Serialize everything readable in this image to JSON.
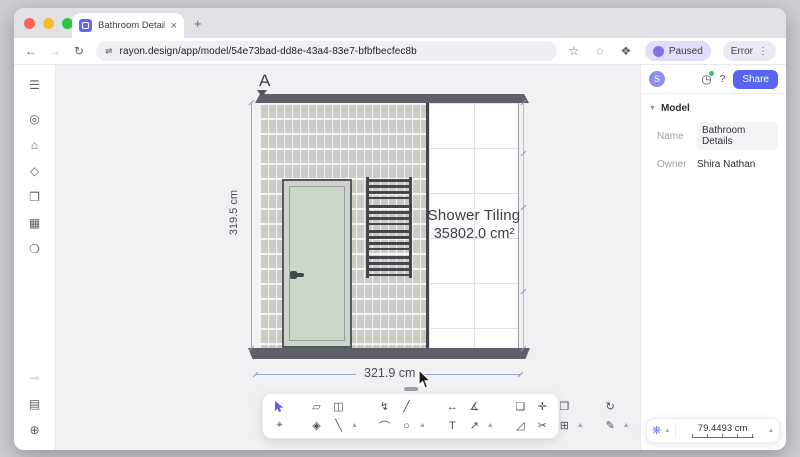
{
  "browser": {
    "tab_title": "Bathroom Details  | Rayon",
    "tab_close": "×",
    "new_tab": "+",
    "back": "←",
    "forward": "→",
    "reload": "↻",
    "site_settings_icon": "⇌",
    "url": "rayon.design/app/model/54e73bad-dd8e-43a4-83e7-bfbfbecfec8b",
    "bookmark_icon": "☆",
    "lens_icon": "◌",
    "extensions_icon": "❖",
    "paused_label": "Paused",
    "error_label": "Error",
    "kebab": "⋮"
  },
  "sidebar": {
    "top": [
      {
        "n": "menu-icon",
        "g": "☰",
        "menu": true
      },
      {
        "n": "scene-icon",
        "g": "◎"
      },
      {
        "n": "model-cube-icon",
        "g": "⌂"
      },
      {
        "n": "materials-icon",
        "g": "◇"
      },
      {
        "n": "pages-icon",
        "g": "❐"
      },
      {
        "n": "tables-icon",
        "g": "▦"
      },
      {
        "n": "comments-icon",
        "g": "❍"
      }
    ],
    "bottom": [
      {
        "n": "plugins-icon",
        "g": "⊸",
        "muted": true
      },
      {
        "n": "library-icon",
        "g": "▤"
      },
      {
        "n": "help-icon",
        "g": "⊕"
      }
    ]
  },
  "panel": {
    "avatar": "S",
    "history_icon": "◷",
    "help_label": "?",
    "share_label": "Share",
    "section_chevron": "▼",
    "section_title": "Model",
    "fields": [
      {
        "label": "Name",
        "value": "Bathroom Details",
        "input": true
      },
      {
        "label": "Owner",
        "value": "Shira Nathan",
        "input": false
      }
    ]
  },
  "canvas": {
    "section_marker": "A",
    "height_dim": "319.5 cm",
    "width_dim": "321.9 cm",
    "area_title": "Shower Tiling",
    "area_value": "35802.0 cm²"
  },
  "toolbar": {
    "groups": [
      {
        "cols": [
          {
            "top": {
              "n": "select-tool",
              "g": "svg:cursor",
              "active": true
            },
            "bot": {
              "n": "node-select-tool",
              "g": "⌖"
            }
          }
        ],
        "chevron": false
      },
      {
        "cols": [
          {
            "top": {
              "n": "slab-tool",
              "g": "▱"
            },
            "bot": {
              "n": "hatch-tool",
              "g": "◈"
            }
          },
          {
            "top": {
              "n": "door-tool",
              "g": "◫"
            },
            "bot": {
              "n": "wall-line-tool",
              "g": "╲"
            }
          }
        ],
        "chevron": true
      },
      {
        "cols": [
          {
            "top": {
              "n": "polyline-tool",
              "g": "↯"
            },
            "bot": {
              "n": "arc-tool",
              "g": "⌒"
            }
          },
          {
            "top": {
              "n": "line-tool",
              "g": "╱"
            },
            "bot": {
              "n": "circle-tool",
              "g": "○"
            }
          }
        ],
        "chevron": true
      },
      {
        "cols": [
          {
            "top": {
              "n": "linear-dimension-tool",
              "g": "↔"
            },
            "bot": {
              "n": "text-tool",
              "g": "T"
            }
          },
          {
            "top": {
              "n": "angular-dimension-tool",
              "g": "∡"
            },
            "bot": {
              "n": "leader-tool",
              "g": "↗"
            }
          }
        ],
        "chevron": true
      },
      {
        "cols": [
          {
            "top": {
              "n": "copy-tool",
              "g": "❏"
            },
            "bot": {
              "n": "stretch-tool",
              "g": "◿"
            }
          },
          {
            "top": {
              "n": "move-tool",
              "g": "✛"
            },
            "bot": {
              "n": "trim-tool",
              "g": "✂"
            }
          },
          {
            "top": {
              "n": "offset-tool",
              "g": "❐"
            },
            "bot": {
              "n": "array-tool",
              "g": "⊞"
            }
          }
        ],
        "chevron": true
      },
      {
        "cols": [
          {
            "top": {
              "n": "rotate-tool",
              "g": "↻"
            },
            "bot": {
              "n": "erase-tool",
              "g": "✎"
            }
          }
        ],
        "chevron": true
      },
      {
        "cols": [
          {
            "top": {
              "n": "comment-tool",
              "g": "❍"
            },
            "bot": {
              "n": "export-tool",
              "g": "⊟"
            }
          }
        ],
        "chevron": true
      }
    ]
  },
  "scale_widget": {
    "snap_icon": "❋",
    "chevron": "▲",
    "value": "79.4493 cm"
  },
  "colors": {
    "accent": "#5766f2",
    "beam": "#5d6167",
    "tile_green": "#c7cfc5",
    "dimension": "#9aa5d8"
  }
}
